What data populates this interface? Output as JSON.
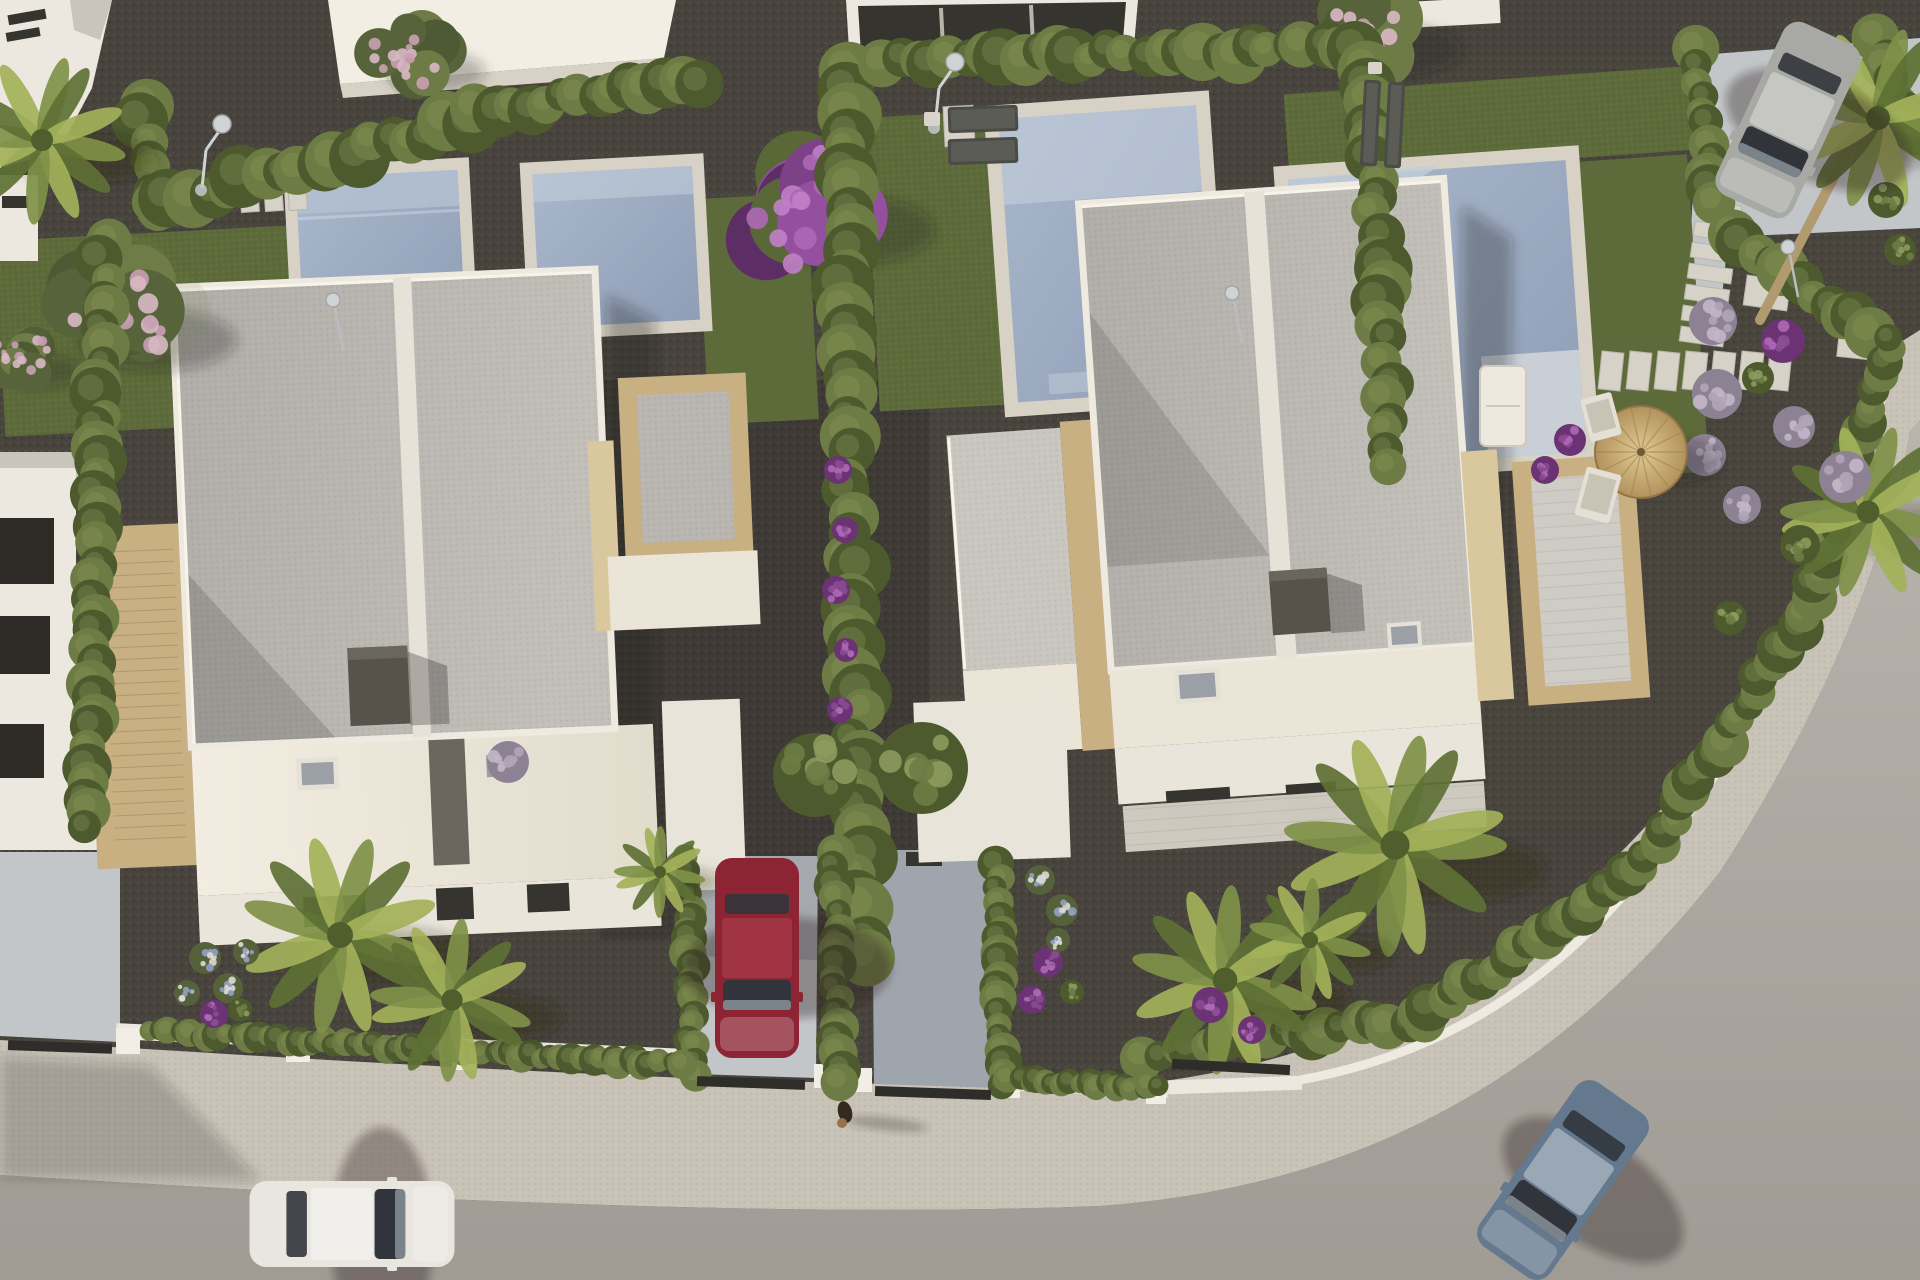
{
  "meta": {
    "title": "Aerial 3D render of modern villa development",
    "description": "Top-down architectural rendering: two white flat-roof duplex villas with private pools and gravel gardens, cypress hedges, palm trees, purple flowering shrubs, a curved asphalt road with sidewalk, a parked red car in a driveway, a white car and a blue-grey car on the road, a silver car on a rear parking pad, sun loungers, a straw parasol and a small dog on the pavement.",
    "canvas": {
      "w": 1920,
      "h": 1280
    }
  },
  "objects_summary": {
    "houses": 2,
    "neighbor_building_fragments": 4,
    "pools": 4,
    "cars": 4,
    "sun_lounger_pairs": 2,
    "parasols": 1,
    "outdoor_showers": 2,
    "garden_lamps": 3,
    "dogs": 1,
    "driveways": 3,
    "stepping_stone_runs": 3
  },
  "palette": {
    "gravel": "#48443d",
    "gravel_dark": "#3a3731",
    "gravel_warm": "#554f48",
    "grass": "#5d6b3a",
    "grass_dark": "#46532c",
    "hedge": "#6d7c44",
    "hedge_dark": "#4c5a2e",
    "hedge_light": "#8d9a5e",
    "road": "#b7b2ab",
    "road_dark": "#a09b94",
    "sidewalk": "#c8c2b7",
    "curb": "#dcd7cd",
    "wall_white": "#ece8df",
    "wall_shadow": "#c9c4ba",
    "concrete_drive": "#c3c6c9",
    "drive_shadow": "#9fa5ad",
    "pool_coping": "#d7d2c5",
    "pool_water": "#9dabc1",
    "pool_water_light": "#c2cdda",
    "pool_steps": "#b3bfd0",
    "roof_gray": "#b5b2ad",
    "roof_light": "#c6c3bd",
    "parapet": "#efeae0",
    "spine": "#e7e2d8",
    "terrace_cream": "#ebe5d7",
    "stone_tan": "#c8b083",
    "stone_tan_light": "#d9c79e",
    "chimney": "#57534b",
    "window_dark": "#36342f",
    "glass_gray": "#9aa0a6",
    "purple": "#8a4a92",
    "purple_dark": "#6b3374",
    "purple_bright": "#ad68b5",
    "lavender_base": "#8d8194",
    "lavender_dot": "#c3b6c8",
    "pink": "#c9a0b4",
    "pink_light": "#d8b8c4",
    "white_flower": "#dddcd6",
    "blue_flower": "#93a0c4",
    "palm": "#7f9148",
    "palm_dark": "#5d7034",
    "palm_light": "#a3b159",
    "trunk": "#b09a6e",
    "straw": "#cdb277",
    "straw_dark": "#9d8050",
    "chrome": "#cfd3d5",
    "car_white": "#e9e6e0",
    "car_red": "#8c2433",
    "car_silver": "#a8a8a4",
    "car_blue": "#64788e",
    "shadow": "rgba(35,32,28,0.32)"
  },
  "vegetation": {
    "hedges": [
      {
        "x1": 143,
        "y1": 102,
        "x2": 152,
        "y2": 205,
        "r": 24
      },
      {
        "x1": 152,
        "y1": 208,
        "x2": 468,
        "y2": 122,
        "r": 26
      },
      {
        "x1": 480,
        "y1": 112,
        "x2": 695,
        "y2": 80,
        "r": 22
      },
      {
        "x1": 104,
        "y1": 246,
        "x2": 88,
        "y2": 830,
        "r": 22
      },
      {
        "x1": 842,
        "y1": 72,
        "x2": 862,
        "y2": 955,
        "r": 27
      },
      {
        "x1": 880,
        "y1": 60,
        "x2": 1360,
        "y2": 48,
        "r": 24
      },
      {
        "x1": 1366,
        "y1": 68,
        "x2": 1392,
        "y2": 470,
        "r": 24
      },
      {
        "x1": 1698,
        "y1": 52,
        "x2": 1712,
        "y2": 200,
        "r": 20
      },
      {
        "x1": 1728,
        "y1": 235,
        "x2": 1872,
        "y2": 330,
        "r": 22
      },
      {
        "x1": 1876,
        "y1": 40,
        "x2": 1918,
        "y2": 140,
        "r": 20
      },
      {
        "x1": 1146,
        "y1": 1054,
        "x2": 1420,
        "y2": 1018,
        "r": 20
      },
      {
        "x1": 1420,
        "y1": 1018,
        "x2": 1640,
        "y2": 868,
        "r": 20
      },
      {
        "x1": 1640,
        "y1": 868,
        "x2": 1812,
        "y2": 600,
        "r": 20
      },
      {
        "x1": 1812,
        "y1": 600,
        "x2": 1892,
        "y2": 335,
        "r": 19
      },
      {
        "x1": 688,
        "y1": 858,
        "x2": 692,
        "y2": 1072,
        "r": 16
      },
      {
        "x1": 835,
        "y1": 850,
        "x2": 838,
        "y2": 1080,
        "r": 17
      },
      {
        "x1": 998,
        "y1": 855,
        "x2": 1000,
        "y2": 1086,
        "r": 16
      },
      {
        "x1": 150,
        "y1": 1032,
        "x2": 680,
        "y2": 1064,
        "r": 13
      },
      {
        "x1": 1010,
        "y1": 1080,
        "x2": 1160,
        "y2": 1088,
        "r": 12
      }
    ],
    "bushes": [
      {
        "x": 815,
        "y": 775,
        "r": 42,
        "kind": "green"
      },
      {
        "x": 922,
        "y": 768,
        "r": 46,
        "kind": "green"
      },
      {
        "x": 762,
        "y": 902,
        "r": 15,
        "kind": "green"
      },
      {
        "x": 780,
        "y": 932,
        "r": 13,
        "kind": "green"
      },
      {
        "x": 838,
        "y": 470,
        "r": 14,
        "kind": "purple"
      },
      {
        "x": 845,
        "y": 530,
        "r": 13,
        "kind": "purple"
      },
      {
        "x": 836,
        "y": 590,
        "r": 14,
        "kind": "purple"
      },
      {
        "x": 846,
        "y": 650,
        "r": 12,
        "kind": "purple"
      },
      {
        "x": 840,
        "y": 710,
        "r": 13,
        "kind": "purple"
      },
      {
        "x": 1713,
        "y": 321,
        "r": 24,
        "kind": "lavender"
      },
      {
        "x": 1783,
        "y": 341,
        "r": 22,
        "kind": "purple"
      },
      {
        "x": 1717,
        "y": 394,
        "r": 25,
        "kind": "lavender"
      },
      {
        "x": 1794,
        "y": 427,
        "r": 21,
        "kind": "lavender"
      },
      {
        "x": 1845,
        "y": 477,
        "r": 26,
        "kind": "lavender"
      },
      {
        "x": 1758,
        "y": 378,
        "r": 16,
        "kind": "green"
      },
      {
        "x": 1800,
        "y": 545,
        "r": 20,
        "kind": "green"
      },
      {
        "x": 1730,
        "y": 618,
        "r": 17,
        "kind": "green"
      },
      {
        "x": 1705,
        "y": 455,
        "r": 21,
        "kind": "lavender"
      },
      {
        "x": 1742,
        "y": 505,
        "r": 19,
        "kind": "lavender"
      },
      {
        "x": 1570,
        "y": 440,
        "r": 16,
        "kind": "purple"
      },
      {
        "x": 1545,
        "y": 470,
        "r": 14,
        "kind": "purple"
      },
      {
        "x": 1598,
        "y": 492,
        "r": 13,
        "kind": "purple"
      },
      {
        "x": 1210,
        "y": 1005,
        "r": 18,
        "kind": "purple"
      },
      {
        "x": 1252,
        "y": 1030,
        "r": 14,
        "kind": "purple"
      },
      {
        "x": 205,
        "y": 958,
        "r": 16,
        "kind": "whiteblue"
      },
      {
        "x": 228,
        "y": 988,
        "r": 15,
        "kind": "whiteblue"
      },
      {
        "x": 246,
        "y": 952,
        "r": 13,
        "kind": "whiteblue"
      },
      {
        "x": 214,
        "y": 1014,
        "r": 14,
        "kind": "purple"
      },
      {
        "x": 187,
        "y": 993,
        "r": 13,
        "kind": "whiteblue"
      },
      {
        "x": 240,
        "y": 1010,
        "r": 12,
        "kind": "green"
      },
      {
        "x": 1040,
        "y": 880,
        "r": 15,
        "kind": "whiteblue"
      },
      {
        "x": 1062,
        "y": 910,
        "r": 16,
        "kind": "whiteblue"
      },
      {
        "x": 1048,
        "y": 962,
        "r": 15,
        "kind": "purple"
      },
      {
        "x": 1032,
        "y": 1000,
        "r": 14,
        "kind": "purple"
      },
      {
        "x": 1072,
        "y": 992,
        "r": 12,
        "kind": "green"
      },
      {
        "x": 1058,
        "y": 940,
        "r": 12,
        "kind": "whiteblue"
      },
      {
        "x": 508,
        "y": 762,
        "r": 21,
        "kind": "lavender"
      },
      {
        "x": 1886,
        "y": 200,
        "r": 18,
        "kind": "green"
      },
      {
        "x": 1900,
        "y": 250,
        "r": 16,
        "kind": "green"
      }
    ],
    "palms": [
      {
        "x": 340,
        "y": 935,
        "r": 100
      },
      {
        "x": 452,
        "y": 1000,
        "r": 82
      },
      {
        "x": 660,
        "y": 872,
        "r": 46
      },
      {
        "x": 1225,
        "y": 980,
        "r": 95
      },
      {
        "x": 1395,
        "y": 845,
        "r": 112
      },
      {
        "x": 1310,
        "y": 940,
        "r": 62
      },
      {
        "x": 1868,
        "y": 512,
        "r": 88
      },
      {
        "x": 1878,
        "y": 118,
        "r": 92
      },
      {
        "x": 42,
        "y": 140,
        "r": 85
      }
    ],
    "palm_trunks": [
      {
        "x1": 1760,
        "y1": 320,
        "x2": 1852,
        "y2": 142
      }
    ],
    "trees": [
      {
        "x": 118,
        "y": 318,
        "r": 88,
        "kind": "pinkgreen"
      },
      {
        "x": 800,
        "y": 205,
        "r": 100,
        "kind": "purpletree"
      },
      {
        "x": 1365,
        "y": 32,
        "r": 72,
        "kind": "pinkgreen"
      },
      {
        "x": 410,
        "y": 58,
        "r": 56,
        "kind": "pinkgreen"
      },
      {
        "x": 22,
        "y": 360,
        "r": 45,
        "kind": "pinkgreen"
      }
    ]
  },
  "props": {
    "slabs": [
      {
        "x": 240,
        "y": 170,
        "w": 18,
        "h": 42,
        "rot": -4
      },
      {
        "x": 264,
        "y": 169,
        "w": 18,
        "h": 42,
        "rot": -4
      },
      {
        "x": 288,
        "y": 168,
        "w": 18,
        "h": 42,
        "rot": -4
      },
      {
        "x": 944,
        "y": 106,
        "w": 30,
        "h": 40,
        "rot": -3
      },
      {
        "x": 1700,
        "y": 182,
        "w": 44,
        "h": 15,
        "rot": 8
      },
      {
        "x": 1697,
        "y": 203,
        "w": 44,
        "h": 15,
        "rot": 8
      },
      {
        "x": 1694,
        "y": 224,
        "w": 44,
        "h": 15,
        "rot": 8
      },
      {
        "x": 1691,
        "y": 245,
        "w": 44,
        "h": 15,
        "rot": 8
      },
      {
        "x": 1688,
        "y": 266,
        "w": 44,
        "h": 15,
        "rot": 8
      },
      {
        "x": 1685,
        "y": 287,
        "w": 44,
        "h": 15,
        "rot": 8
      },
      {
        "x": 1682,
        "y": 308,
        "w": 44,
        "h": 15,
        "rot": 8
      },
      {
        "x": 1680,
        "y": 329,
        "w": 44,
        "h": 15,
        "rot": 8
      },
      {
        "x": 1600,
        "y": 352,
        "w": 22,
        "h": 38,
        "rot": 6
      },
      {
        "x": 1628,
        "y": 352,
        "w": 22,
        "h": 38,
        "rot": 6
      },
      {
        "x": 1656,
        "y": 352,
        "w": 22,
        "h": 38,
        "rot": 6
      },
      {
        "x": 1684,
        "y": 352,
        "w": 22,
        "h": 38,
        "rot": 6
      },
      {
        "x": 1712,
        "y": 352,
        "w": 22,
        "h": 38,
        "rot": 6
      },
      {
        "x": 1740,
        "y": 352,
        "w": 22,
        "h": 38,
        "rot": 6
      },
      {
        "x": 1768,
        "y": 352,
        "w": 22,
        "h": 38,
        "rot": 6
      },
      {
        "x": 1745,
        "y": 278,
        "w": 44,
        "h": 30,
        "rot": 8
      },
      {
        "x": 1838,
        "y": 333,
        "w": 50,
        "h": 26,
        "rot": 6
      }
    ],
    "showers": [
      {
        "x": 222,
        "y": 124
      },
      {
        "x": 955,
        "y": 62
      }
    ],
    "lamps": [
      {
        "x": 333,
        "y": 300
      },
      {
        "x": 1232,
        "y": 293
      },
      {
        "x": 1788,
        "y": 247
      }
    ],
    "loungers": [
      {
        "x": 948,
        "y": 106,
        "w": 70,
        "h": 26,
        "rot": -2
      },
      {
        "x": 948,
        "y": 138,
        "w": 70,
        "h": 26,
        "rot": -2
      },
      {
        "x": 1362,
        "y": 80,
        "w": 17,
        "h": 86,
        "rot": 3
      },
      {
        "x": 1386,
        "y": 82,
        "w": 17,
        "h": 86,
        "rot": 3
      }
    ],
    "side_tables": [
      {
        "x": 924,
        "y": 112,
        "w": 16,
        "h": 14
      },
      {
        "x": 1368,
        "y": 62,
        "w": 14,
        "h": 12
      }
    ],
    "parasol": {
      "x": 1641,
      "y": 452,
      "r": 46
    },
    "deck_chairs": [
      {
        "x": 1585,
        "y": 395,
        "w": 32,
        "h": 44,
        "rot": -15
      },
      {
        "x": 1580,
        "y": 470,
        "w": 36,
        "h": 50,
        "rot": 15
      }
    ],
    "sofa": {
      "x": 1480,
      "y": 366,
      "w": 46,
      "h": 80
    },
    "dog": {
      "x": 845,
      "y": 1112
    },
    "gates": [
      {
        "x": 8,
        "y": 1042,
        "w": 104,
        "h": 10,
        "rot": 2
      },
      {
        "x": 697,
        "y": 1078,
        "w": 108,
        "h": 10,
        "rot": 2
      },
      {
        "x": 875,
        "y": 1088,
        "w": 116,
        "h": 10,
        "rot": 2
      },
      {
        "x": 1172,
        "y": 1062,
        "w": 118,
        "h": 10,
        "rot": 3
      }
    ]
  },
  "vehicles": [
    {
      "name": "white-car-on-road",
      "cx": 352,
      "cy": 1224,
      "len": 205,
      "wid": 86,
      "rot": 90,
      "body": "car_white"
    },
    {
      "name": "red-car-driveway",
      "cx": 757,
      "cy": 958,
      "len": 200,
      "wid": 84,
      "rot": 180,
      "body": "car_red"
    },
    {
      "name": "silver-car-parking-pad",
      "cx": 1788,
      "cy": 120,
      "len": 190,
      "wid": 84,
      "rot": 205,
      "body": "car_silver"
    },
    {
      "name": "blue-car-on-road",
      "cx": 1563,
      "cy": 1180,
      "len": 200,
      "wid": 86,
      "rot": 215,
      "body": "car_blue"
    }
  ]
}
